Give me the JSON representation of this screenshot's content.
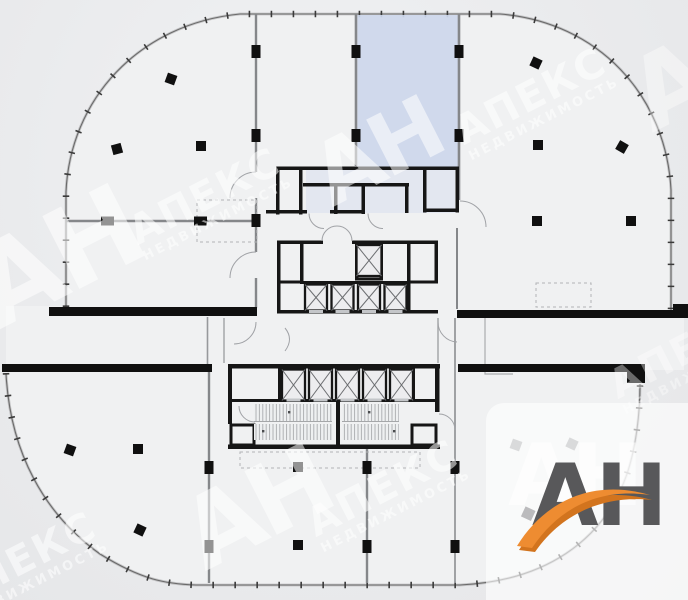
{
  "watermark": {
    "an": "АН",
    "brand": "АПЕКС",
    "sub": "НЕДВИЖИМОСТЬ"
  },
  "logo": {
    "text": "АН",
    "echo": "АН"
  },
  "colors": {
    "background": "#eaebed",
    "highlighted_room": "#cdd7ec",
    "wall_black": "#161616",
    "wall_gray": "#85878a",
    "facade_line": "#6a6a6a",
    "watermark_white": "#ffffff",
    "logo_text_gray": "#58585a",
    "logo_swoosh_orange": "#ee8c31",
    "logo_swoosh_shadow": "#d2741e",
    "logo_panel_white": "#ffffff"
  }
}
